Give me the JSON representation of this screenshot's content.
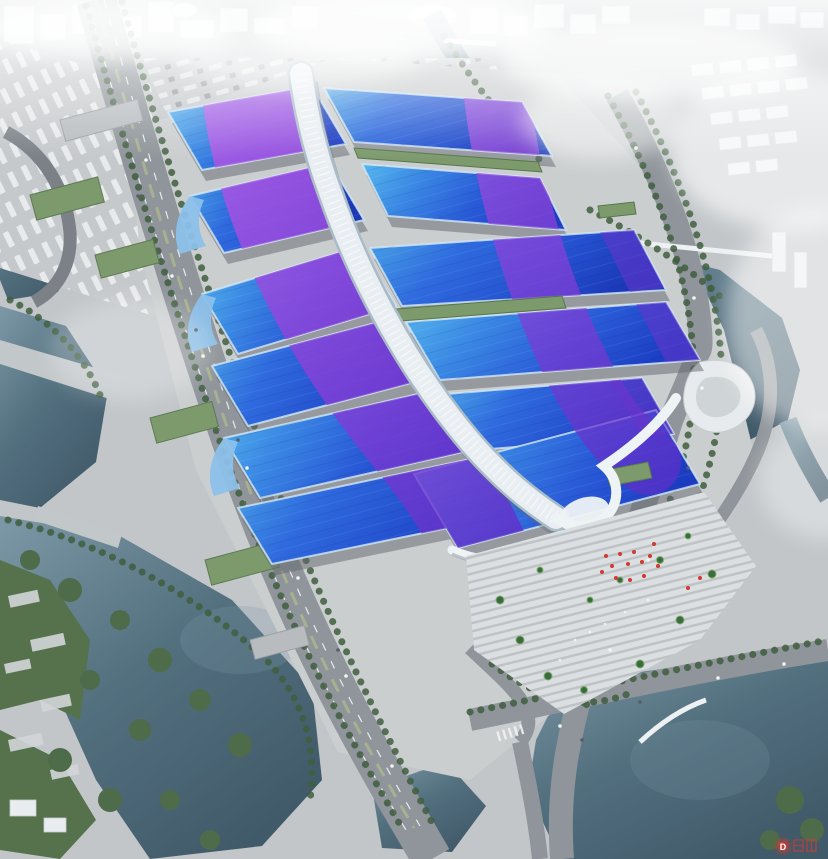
{
  "watermark": {
    "badge_letter": "D"
  },
  "palette": {
    "ground": "#c2c6c9",
    "apron": "#cbcecf",
    "parking": "#c6c9cc",
    "road": "#8f959a",
    "road_dark": "#7b8187",
    "bridge": "#c2c7ca",
    "lane": "#e8ebed",
    "water": "#53707f",
    "water_deep": "#415a6a",
    "water_light": "#7d98a6",
    "green_park": "#55724d",
    "green_tree": "#3f5e3e",
    "green_roof": "#7d9a6d",
    "roof_cyan": "#57b8ee",
    "roof_azure": "#3b8ae4",
    "roof_blue": "#2a5cd8",
    "roof_deep": "#1c3cc2",
    "roof_purple": "#a24fd8",
    "roof_violet": "#6a34cc",
    "spine": "#e9eef2",
    "spine_edge": "#a9bcc8",
    "canopy": "#eef3f6",
    "plaza": "#ced1d4",
    "step_light": "#dcdfe1",
    "step_dark": "#bfc3c6",
    "shadow": "#62686f",
    "city": "#e9edef",
    "city_edge": "#c9ced3",
    "white": "#f5f8fa",
    "accent_red": "#cf3a30"
  }
}
